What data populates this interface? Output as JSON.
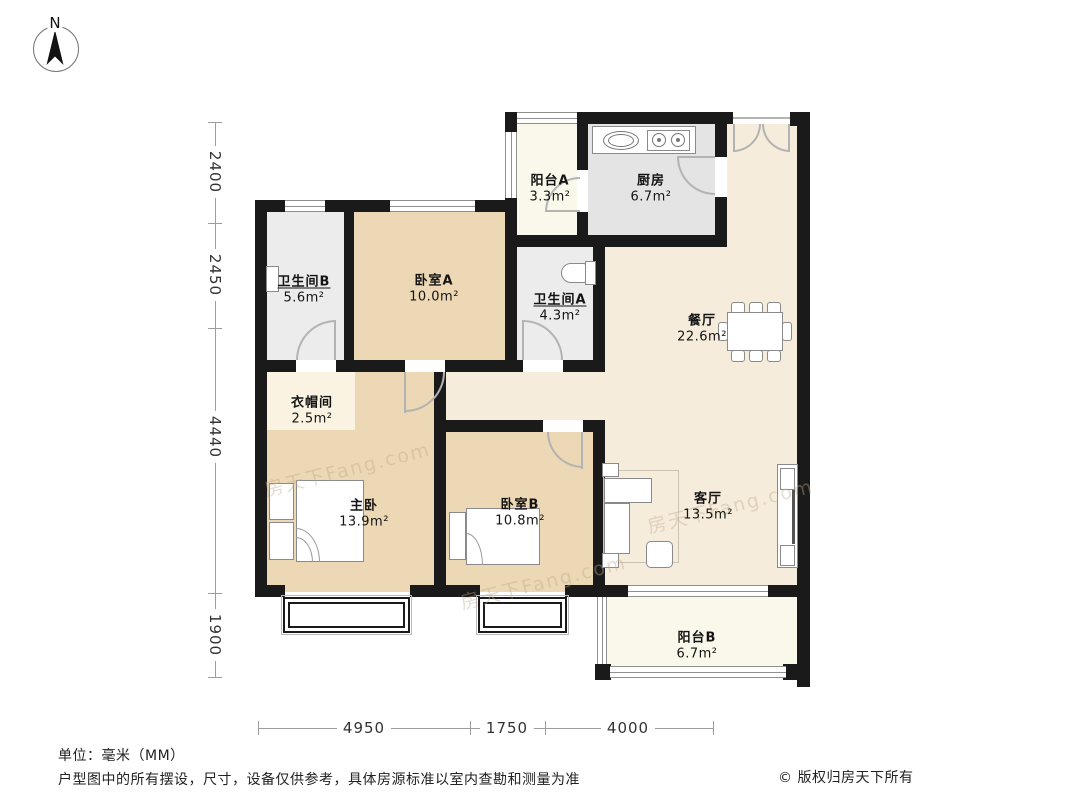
{
  "compass": {
    "label": "N"
  },
  "rooms": [
    {
      "id": "balcony-a",
      "name": "阳台A",
      "area": "3.3m²"
    },
    {
      "id": "kitchen",
      "name": "厨房",
      "area": "6.7m²"
    },
    {
      "id": "bathroom-b",
      "name": "卫生间B",
      "area": "5.6m²"
    },
    {
      "id": "bedroom-a",
      "name": "卧室A",
      "area": "10.0m²"
    },
    {
      "id": "bathroom-a",
      "name": "卫生间A",
      "area": "4.3m²"
    },
    {
      "id": "dining-room",
      "name": "餐厅",
      "area": "22.6m²"
    },
    {
      "id": "cloakroom",
      "name": "衣帽间",
      "area": "2.5m²"
    },
    {
      "id": "master-bedroom",
      "name": "主卧",
      "area": "13.9m²"
    },
    {
      "id": "bedroom-b",
      "name": "卧室B",
      "area": "10.8m²"
    },
    {
      "id": "living-room",
      "name": "客厅",
      "area": "13.5m²"
    },
    {
      "id": "balcony-b",
      "name": "阳台B",
      "area": "6.7m²"
    }
  ],
  "dimensions": {
    "left": [
      "2400",
      "2450",
      "4440",
      "1900"
    ],
    "bottom": [
      "4950",
      "1750",
      "4000"
    ]
  },
  "footer": {
    "unit": "单位：毫米（MM）",
    "disclaimer": "户型图中的所有摆设，尺寸，设备仅供参考，具体房源标准以室内查勘和测量为准",
    "copyright": "© 版权归房天下所有"
  },
  "watermark": "房天下Fang.com",
  "colors": {
    "wall": "#1a1a1a",
    "bedroom_fill": "#ecd8b4",
    "living_fill": "#f6ecdc",
    "bath_fill": "#ececec",
    "kitchen_fill": "#e4e4e4",
    "balcony_fill": "#faf8ea",
    "cloak_fill": "#faf3e2"
  }
}
